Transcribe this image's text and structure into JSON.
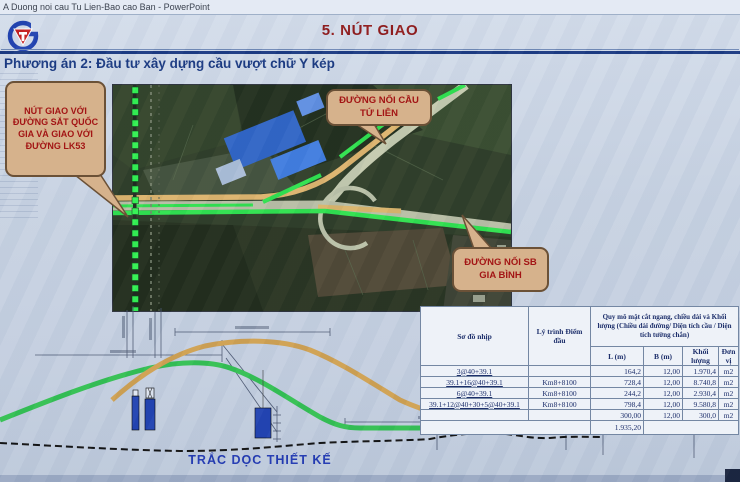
{
  "window": {
    "title": "A Duong noi cau Tu Lien-Bao cao Ban - PowerPoint"
  },
  "slide": {
    "title": "5. NÚT GIAO",
    "subtitle": "Phương án 2: Đầu tư xây dựng cầu vượt chữ Y kép",
    "callouts": {
      "railway": "NÚT GIAO VỚI ĐƯỜNG SẮT QUỐC GIA VÀ GIAO VỚI ĐƯỜNG LK53",
      "tulien": "ĐƯỜNG NỐI CẦU TỨ LIÊN",
      "giabinh": "ĐƯỜNG NỐI SB GIA BÌNH"
    },
    "profile": {
      "caption": "TRẮC DỌC THIẾT KẾ"
    },
    "table": {
      "col1": "Sơ đồ nhịp",
      "col2": "Lý trình Điểm đầu",
      "col3": "Quy mô mặt cắt ngang, chiều dài và Khối lượng (Chiều dài đường/ Diện tích cầu / Diện tích tường chắn)",
      "subcols": [
        "L (m)",
        "B (m)",
        "Khối lượng",
        "Đơn vị"
      ],
      "rows": [
        {
          "span": "3@40+39.1",
          "km": "",
          "L": "164,2",
          "B": "12,00",
          "volume": "1.970,4",
          "unit": "m2"
        },
        {
          "span": "39.1+16@40+39.1",
          "km": "Km8+8100",
          "L": "728,4",
          "B": "12,00",
          "volume": "8.740,8",
          "unit": "m2"
        },
        {
          "span": "6@40+39.1",
          "km": "Km8+8100",
          "L": "244,2",
          "B": "12,00",
          "volume": "2.930,4",
          "unit": "m2"
        },
        {
          "span": "39.1+12@40+30+5@40+39.1",
          "km": "Km8+8100",
          "L": "798,4",
          "B": "12,00",
          "volume": "9.580,8",
          "unit": "m2"
        },
        {
          "span": "",
          "km": "",
          "L": "300,00",
          "B": "12,00",
          "volume": "300,0",
          "unit": "m2"
        }
      ],
      "total": "1.935,20"
    },
    "colors": {
      "title_red": "#8e1616",
      "accent_blue": "#16367f",
      "callout_bg": "#d6b28c",
      "route_green": "#2be04b",
      "route_tan": "#dcb26a"
    }
  }
}
